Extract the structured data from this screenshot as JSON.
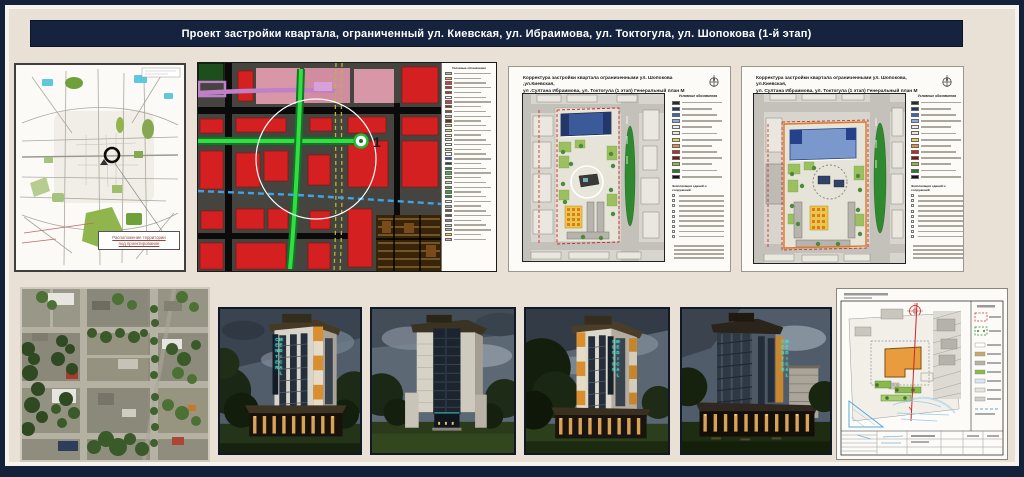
{
  "title_bar": {
    "title": "Проект застройки квартала, ограниченный ул. Киевская, ул. Ибраимова, ул. Токтогула, ул. Шопокова (1-й этап)"
  },
  "city_map": {
    "callout_line1": "Расположение территории",
    "callout_line2": "под проектирование"
  },
  "zoning_map": {
    "site_number": "1",
    "legend_title": "Условные обозначения",
    "legend_swatches": [
      "#C8B89A",
      "#E8A868",
      "#D04038",
      "#CC2A22",
      "#C82A20",
      "#FFFFFF",
      "#D04038",
      "#B02018",
      "#8A5A2A",
      "#C8A878",
      "#5A3A1A",
      "#D8C878",
      "#E8E070",
      "#F6F2DC",
      "#EFEAC9",
      "#FFFFFF",
      "#D8E8C0",
      "#F8F8F0",
      "#2E5AA8",
      "#1A4A2A",
      "#2E8A3A",
      "#38B848",
      "#8CC84C",
      "#C8E0A0",
      "#44AA44",
      "#2FA833",
      "#228855",
      "#EFEFEF",
      "#AAAAAA",
      "#8A5533",
      "#5A5A5A",
      "#8C8C8C",
      "#CCCCCC",
      "#C8B898",
      "#E8E238",
      "#E8A0C0"
    ]
  },
  "genplan_left": {
    "title_line1": "Корректура  застройки квартала ограниченными ул. Шопокова ,ул.Киевская,",
    "title_line2": "ул .Султана Ибраимова, ул. Токтогула (1 этап) Генеральный план М 1:2000"
  },
  "genplan_right": {
    "title_line1": "Корректура  застройки квартала ограниченными ул. Шопокова, ул.Киевская,",
    "title_line2": "ул. Султана Ибраимова, ул. Токтогула (1 этап) Генеральный план М 1:2000"
  },
  "genplan_legend": {
    "title": "Условные обозначения",
    "swatches": [
      "#2B2B2B",
      "#22386A",
      "#3A68B0",
      "#88AADC",
      "#ECECEC",
      "#F0E8D0",
      "#E8D060",
      "#E89030",
      "#CC2222",
      "#881111",
      "#8CBB44",
      "#2A7A2A",
      "#141414"
    ],
    "explication_title": "Экспликация зданий и сооружений",
    "explication_rows": 9,
    "note_rows": 4
  },
  "renders": {
    "sign_text": "MEDICAL CENTER"
  },
  "colors": {
    "frame_navy": "#14213A",
    "titlebar_navy": "#16233E",
    "board_cream": "#EAE1D6",
    "mat_white": "#F7F4EE",
    "accent_orange": "#D98F2E",
    "sign_teal": "#49E2CF",
    "zoning_red": "#D42020",
    "street_green": "#2FBF3A",
    "plan_blue_building": "#3A5A9A",
    "lawn_green": "#2F8A2F"
  }
}
